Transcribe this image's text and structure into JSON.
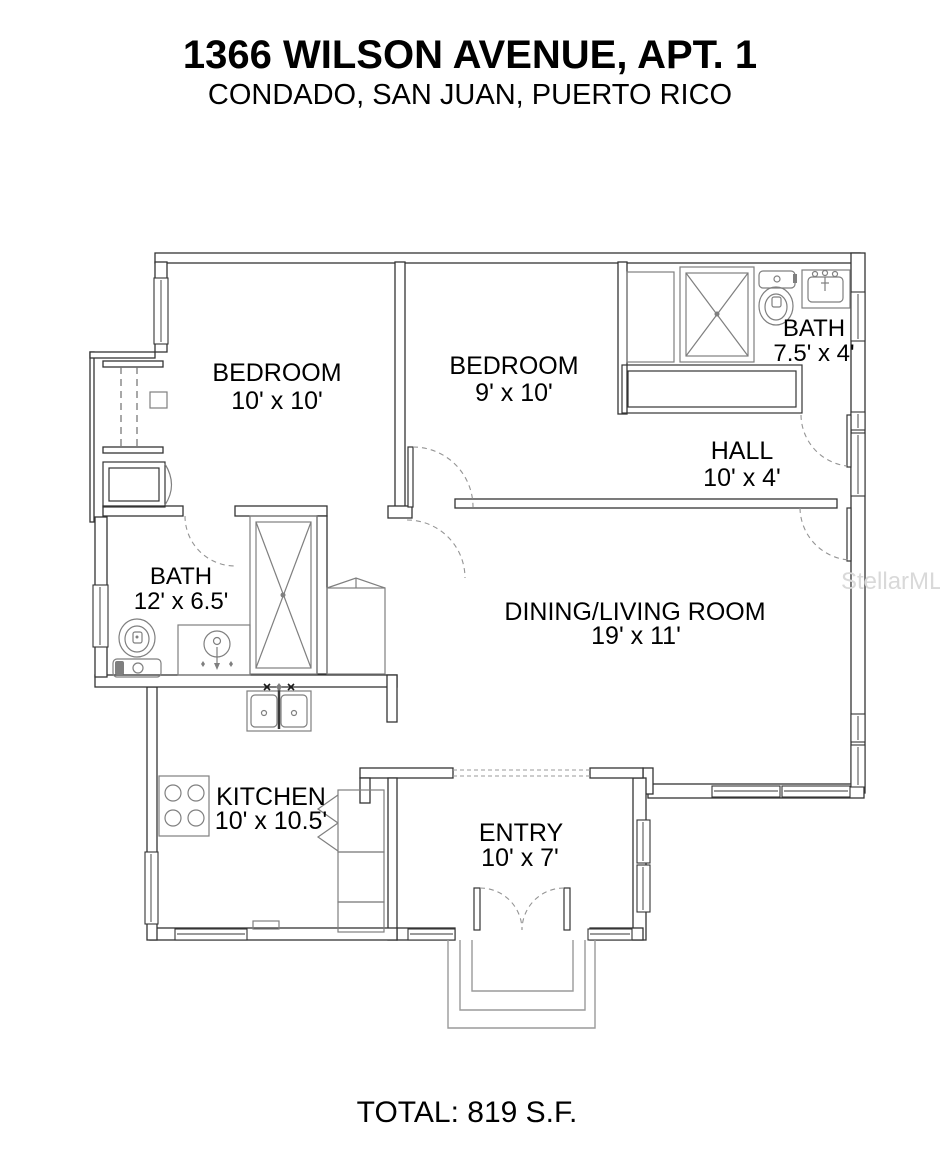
{
  "header": {
    "title": "1366 WILSON AVENUE, APT. 1",
    "subtitle": "CONDADO, SAN JUAN, PUERTO RICO"
  },
  "rooms": {
    "bedroom1": {
      "name": "BEDROOM",
      "dims": "10' x 10'"
    },
    "bedroom2": {
      "name": "BEDROOM",
      "dims": "9' x 10'"
    },
    "bath1": {
      "name": "BATH",
      "dims": "7.5' x 4'"
    },
    "hall": {
      "name": "HALL",
      "dims": "10' x 4'"
    },
    "bath2": {
      "name": "BATH",
      "dims": "12' x 6.5'"
    },
    "dining_living": {
      "name": "DINING/LIVING ROOM",
      "dims": "19' x 11'"
    },
    "kitchen": {
      "name": "KITCHEN",
      "dims": "10' x 10.5'"
    },
    "entry": {
      "name": "ENTRY",
      "dims": "10' x 7'"
    }
  },
  "footer": {
    "total": "TOTAL: 819 S.F."
  },
  "watermark": "StellarMLS",
  "colors": {
    "background": "#ffffff",
    "wall_line": "#343434",
    "fixture_line": "#7f7f7f",
    "text": "#000000",
    "watermark": "#d9d9d9"
  }
}
